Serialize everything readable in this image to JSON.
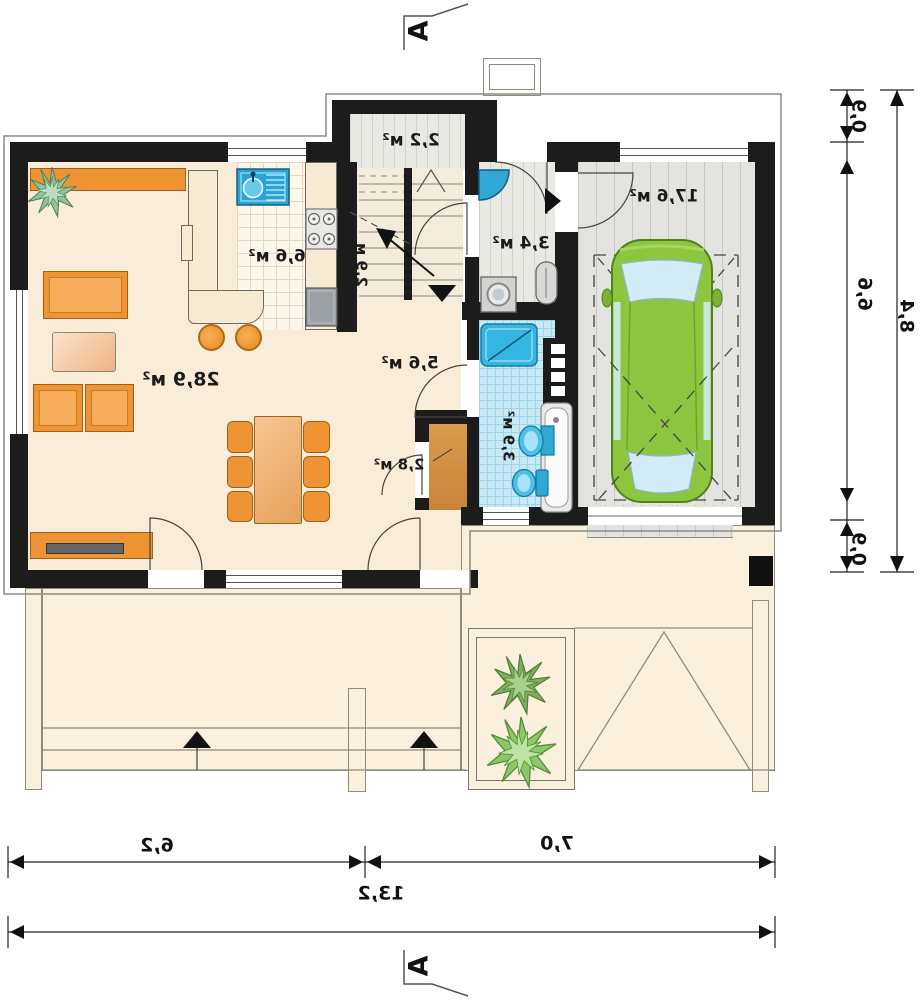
{
  "rooms": {
    "living": "28,9 м²",
    "kitchen": "6,6 м²",
    "vestibule": "2,2 м²",
    "stair_width": "2,9 м",
    "laundry": "3,4 м²",
    "hallway": "5,6 м²",
    "closet": "2,8 м²",
    "bathroom": "3,9 м²",
    "garage": "17,6 м²"
  },
  "dimensions": {
    "right_top": "0,9",
    "right_middle": "6,6",
    "right_bottom": "0,9",
    "right_total": "8,4",
    "bottom_left": "6,2",
    "bottom_right": "7,0",
    "bottom_total": "13,2"
  },
  "markers": {
    "top": "A",
    "bottom": "A"
  },
  "colors": {
    "wall": "#1c1c1c",
    "floor": "#f9ecd9",
    "bath_tile": "#c9eaf5",
    "garage_floor": "#e3e3df",
    "furniture_orange": "#ef9434",
    "car_green": "#8cc63f",
    "plant_green": "#72ad3c",
    "fixture_blue": "#2fa8d5"
  }
}
